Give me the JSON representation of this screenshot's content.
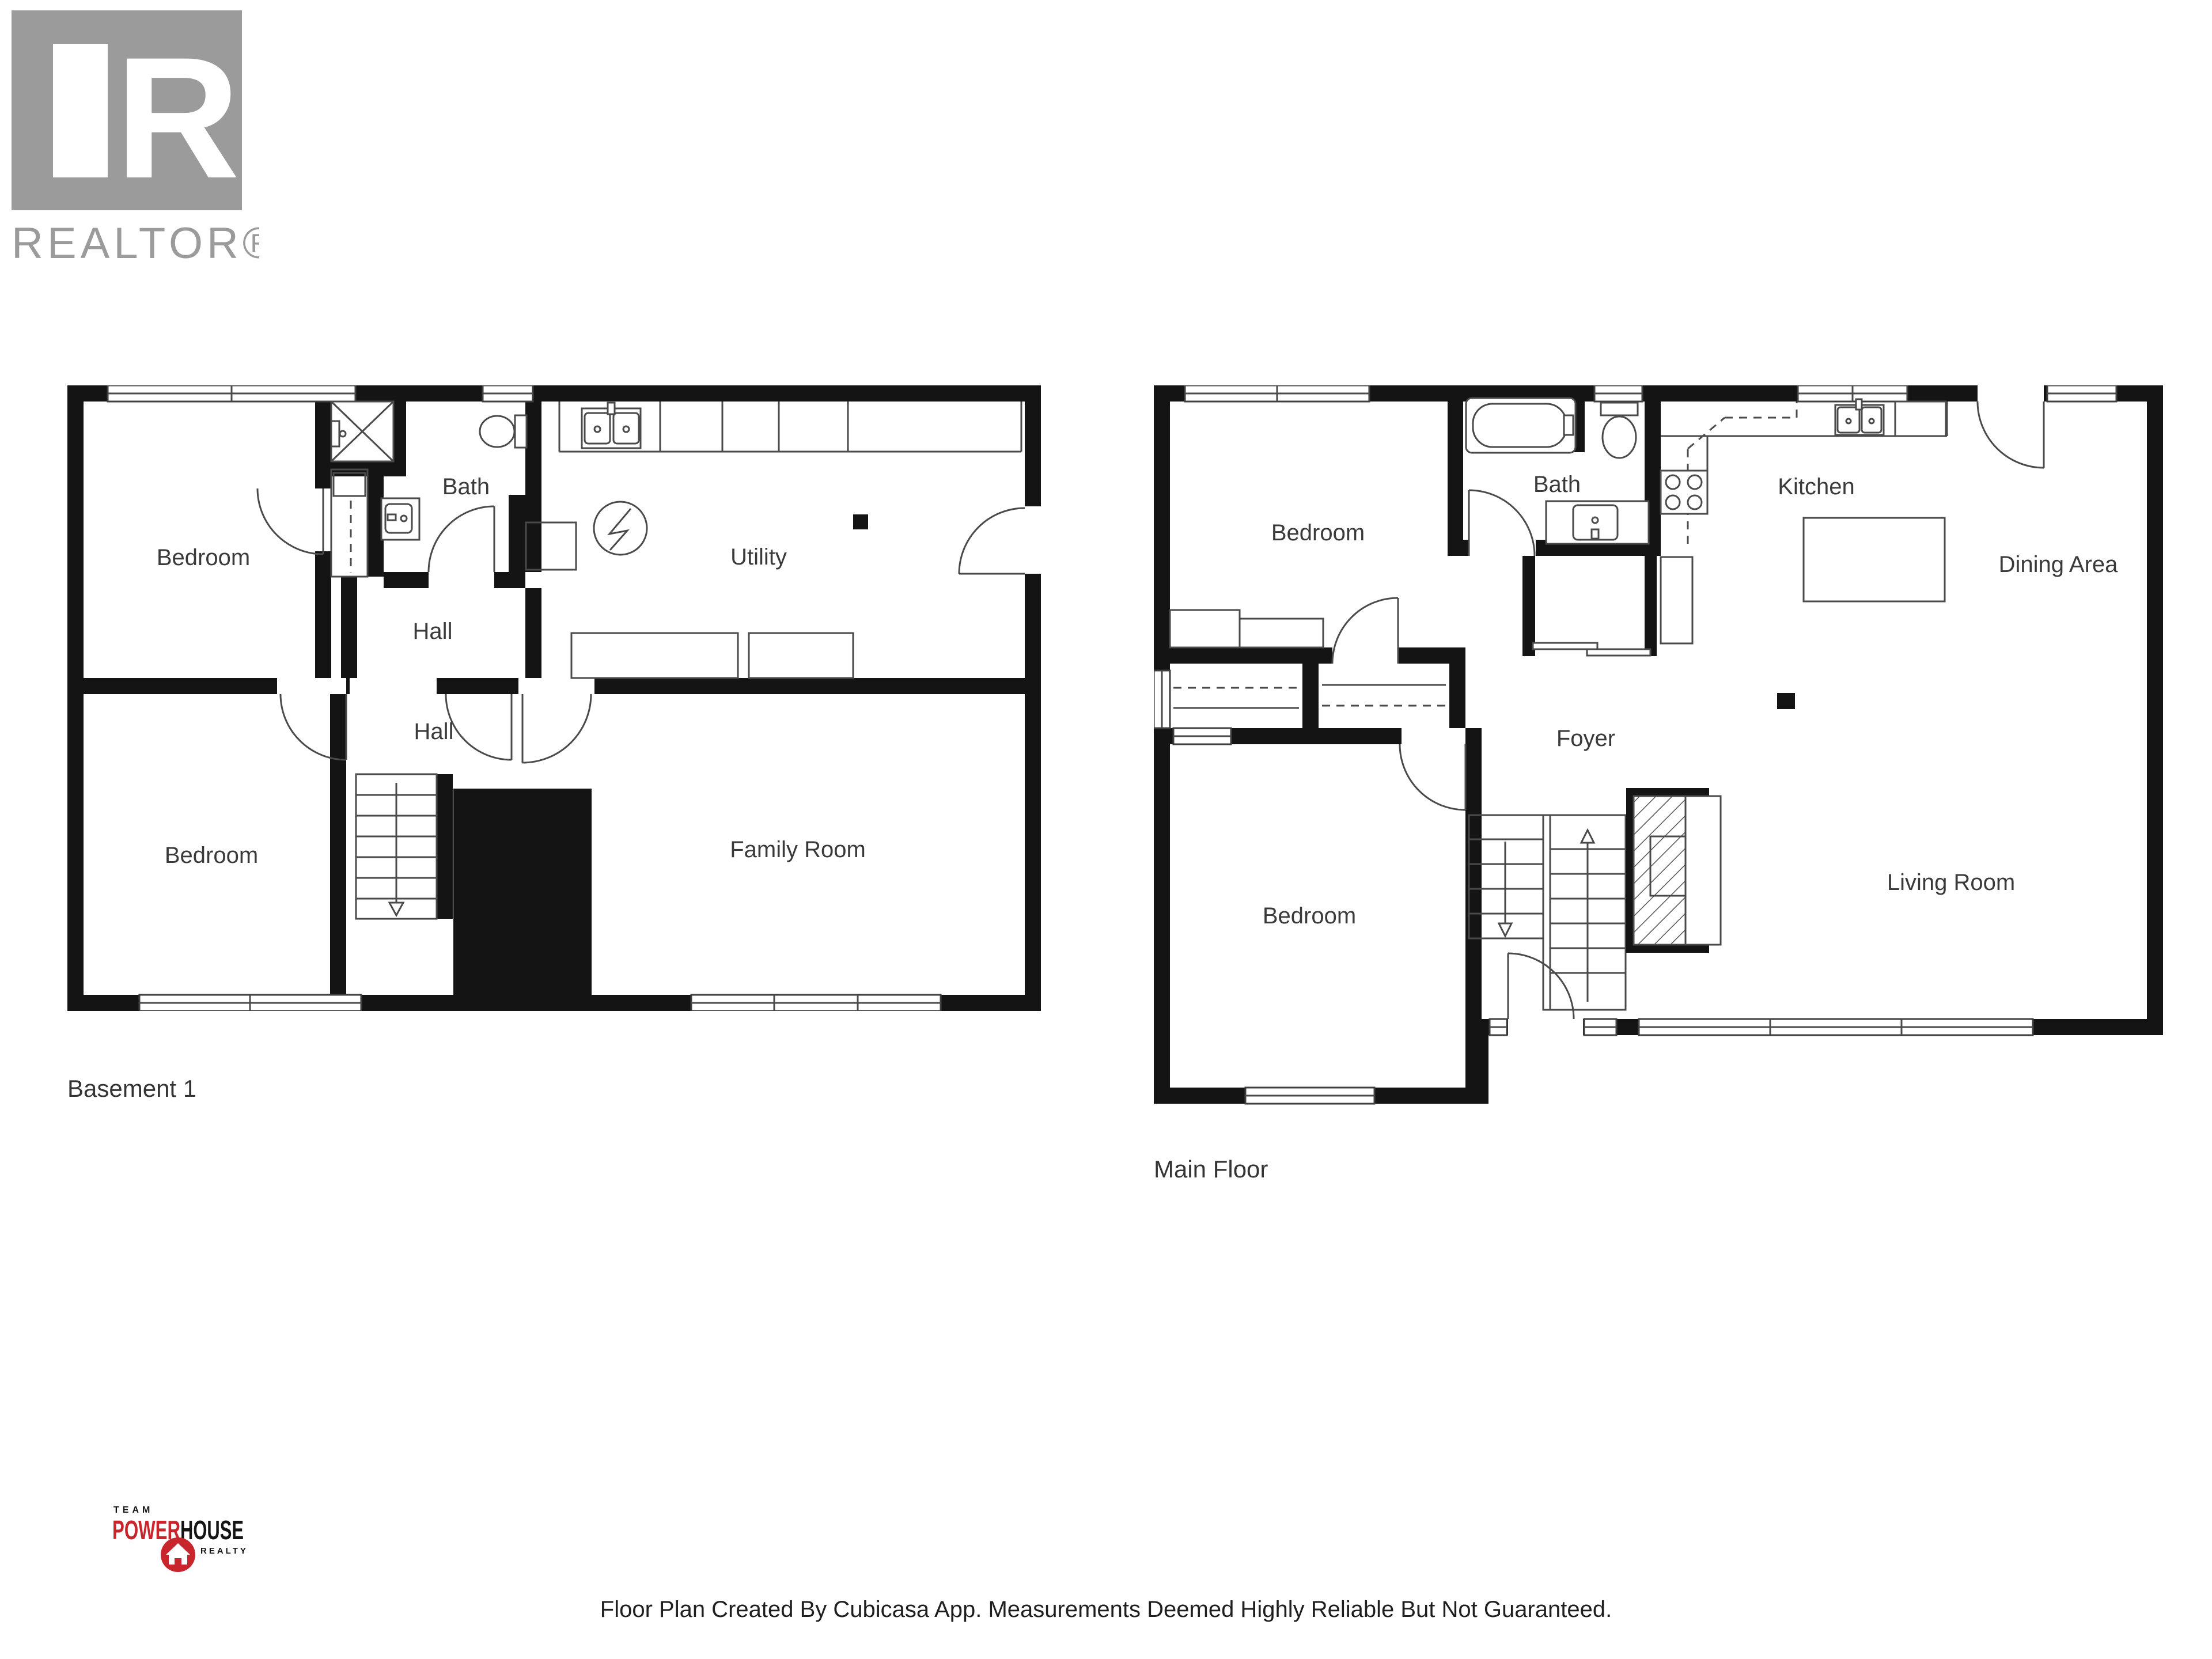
{
  "branding": {
    "realtor_logo_letter": "R",
    "realtor_logo_text": "REALTOR®",
    "gray": "#9b9b9b"
  },
  "team_logo": {
    "team": "TEAM",
    "power": "POWER",
    "house": "HOUSE",
    "realty": "REALTY",
    "red": "#c9252c",
    "black": "#151515"
  },
  "plans": [
    {
      "title": "Basement 1",
      "rooms": [
        "Bedroom",
        "Bath",
        "Hall",
        "Utility",
        "Hall",
        "Bedroom",
        "Family Room"
      ],
      "fixtures": [
        "shower",
        "closet",
        "toilet",
        "sink-vanity",
        "kitchen-sink",
        "counter",
        "water-heater",
        "stairs-down",
        "post"
      ]
    },
    {
      "title": "Main Floor",
      "rooms": [
        "Bedroom",
        "Bath",
        "Kitchen",
        "Dining Area",
        "Foyer",
        "Bedroom",
        "Living Room"
      ],
      "fixtures": [
        "bathtub",
        "toilet",
        "sink-vanity",
        "stove",
        "kitchen-sink",
        "island",
        "closets",
        "stairs-up-down",
        "fireplace",
        "post"
      ]
    }
  ],
  "footer": {
    "text": "Floor Plan Created By Cubicasa App. Measurements Deemed Highly Reliable But Not Guaranteed."
  }
}
